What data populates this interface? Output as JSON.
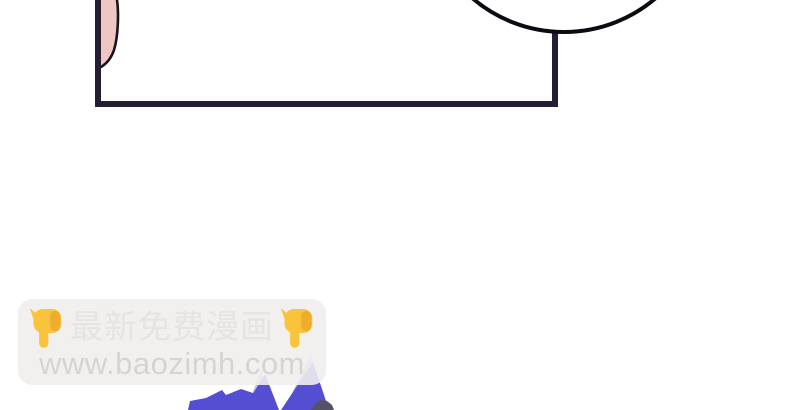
{
  "page": {
    "kind": "manga-page-fragment",
    "background": "#ffffff"
  },
  "watermark": {
    "line1_text": "最新免费漫画",
    "line1_left_icon": "pointing-down-hand-emoji",
    "line1_right_icon": "pointing-down-hand-emoji",
    "line2_text": "www.baozimh.com"
  },
  "colors": {
    "panel-border": "#251d33",
    "bubble-stroke": "#0d0a12",
    "skin": "#eec7c3",
    "skin-outline": "#1a131d",
    "spike-dark": "#544ed2",
    "spike-light": "#bdb8ec",
    "blob": "#565165",
    "emoji-main": "#f9c33c",
    "emoji-shade": "#eda92c",
    "wm-box": "rgba(239,238,237,0.9)",
    "wm-text1": "#e6e4e3",
    "wm-text2": "#d6d4d3"
  }
}
